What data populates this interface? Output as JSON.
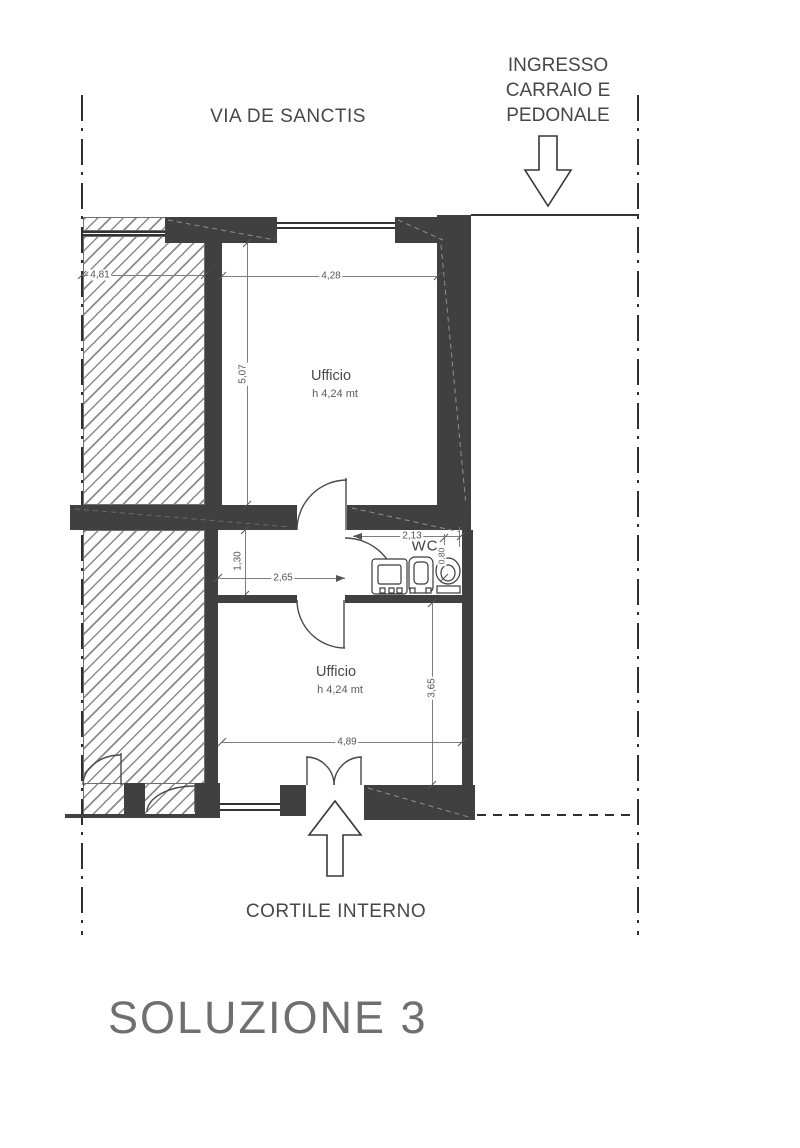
{
  "plan": {
    "street_label": "VIA DE SANCTIS",
    "entrance_label_lines": [
      "INGRESSO",
      "CARRAIO E",
      "PEDONALE"
    ],
    "courtyard_label": "CORTILE INTERNO",
    "solution_title": "SOLUZIONE 3",
    "wc_label": "WC",
    "rooms": [
      {
        "name": "Ufficio",
        "height_note": "h 4,24 mt"
      },
      {
        "name": "Ufficio",
        "height_note": "h 4,24 mt"
      }
    ],
    "dimensions": {
      "adjacent_unit_width": "4,81",
      "office_top_width": "4,28",
      "office_top_depth": "5,07",
      "wc_width": "2,13",
      "corridor_depth": "1,30",
      "corridor_width": "2,65",
      "wc_fixture_width": "0,80",
      "office_bottom_depth": "3,65",
      "office_bottom_width": "4,89"
    },
    "colors": {
      "wall": "#404040",
      "hatch_line": "#8a8a8a",
      "dimension_text": "#545454",
      "label_text": "#474747",
      "title_text": "#6f6f6f"
    }
  }
}
